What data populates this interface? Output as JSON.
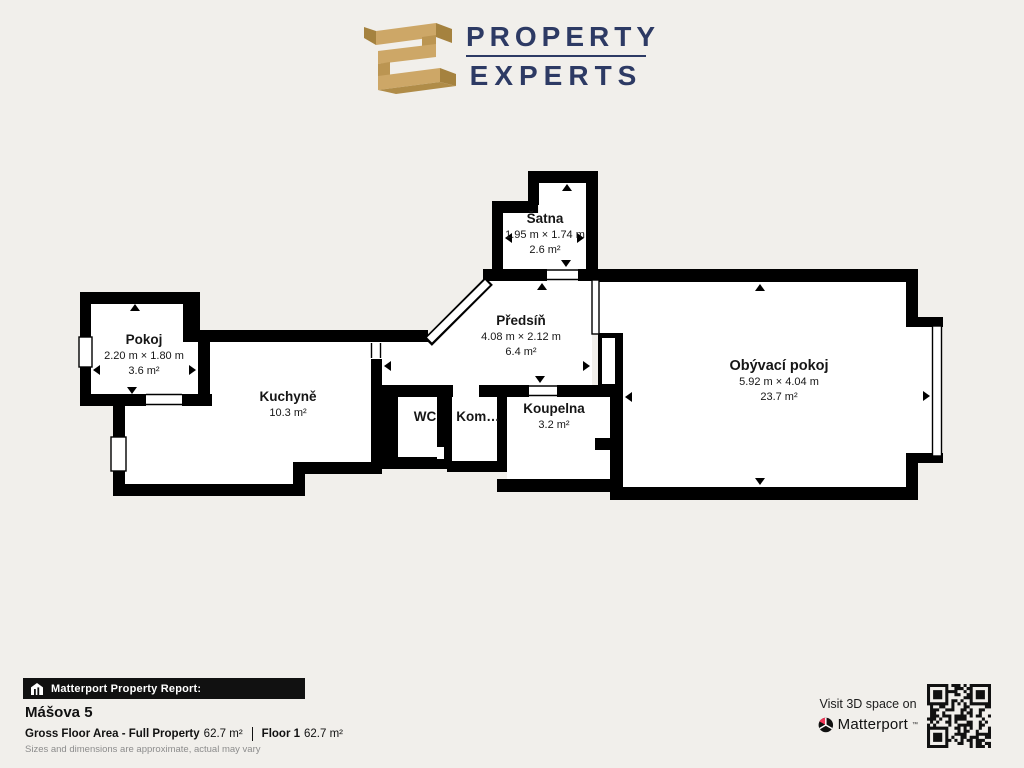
{
  "brand": {
    "line1": "PROPERTY",
    "line2": "EXPERTS"
  },
  "floorplan": {
    "rooms": [
      {
        "id": "pokoj",
        "name": "Pokoj",
        "dims": "2.20 m × 1.80 m",
        "area": "3.6 m²"
      },
      {
        "id": "kuchyne",
        "name": "Kuchyně",
        "dims": "",
        "area": "10.3 m²"
      },
      {
        "id": "satna",
        "name": "Šatna",
        "dims": "1.95 m × 1.74 m",
        "area": "2.6 m²"
      },
      {
        "id": "predsin",
        "name": "Předsíň",
        "dims": "4.08 m × 2.12 m",
        "area": "6.4 m²"
      },
      {
        "id": "wc",
        "name": "WC",
        "dims": "",
        "area": ""
      },
      {
        "id": "komora",
        "name": "Kom…",
        "dims": "",
        "area": ""
      },
      {
        "id": "koupelna",
        "name": "Koupelna",
        "dims": "",
        "area": "3.2 m²"
      },
      {
        "id": "obyvaci",
        "name": "Obývací pokoj",
        "dims": "5.92 m × 4.04 m",
        "area": "23.7 m²"
      }
    ]
  },
  "report": {
    "bar_label": "Matterport Property Report:",
    "property_name": "Mášova 5",
    "gfa_label": "Gross Floor Area - Full Property",
    "gfa_value": "62.7 m²",
    "floor_label": "Floor 1",
    "floor_value": "62.7 m²",
    "disclaimer": "Sizes and dimensions are approximate, actual may vary"
  },
  "cta": {
    "visit": "Visit 3D space on",
    "brand": "Matterport",
    "trademark": "™"
  },
  "icons": {
    "report_bar": "house-chart-icon",
    "matterport": "matterport-pinwheel-icon",
    "qr": "qr-code",
    "brand": "property-experts-3d-glyph"
  },
  "colors": {
    "background": "#f1efeb",
    "wall": "#000000",
    "navy": "#2d3a64",
    "gold": "#cda767",
    "gold_dark": "#a5823f",
    "pink": "#f0395a"
  }
}
